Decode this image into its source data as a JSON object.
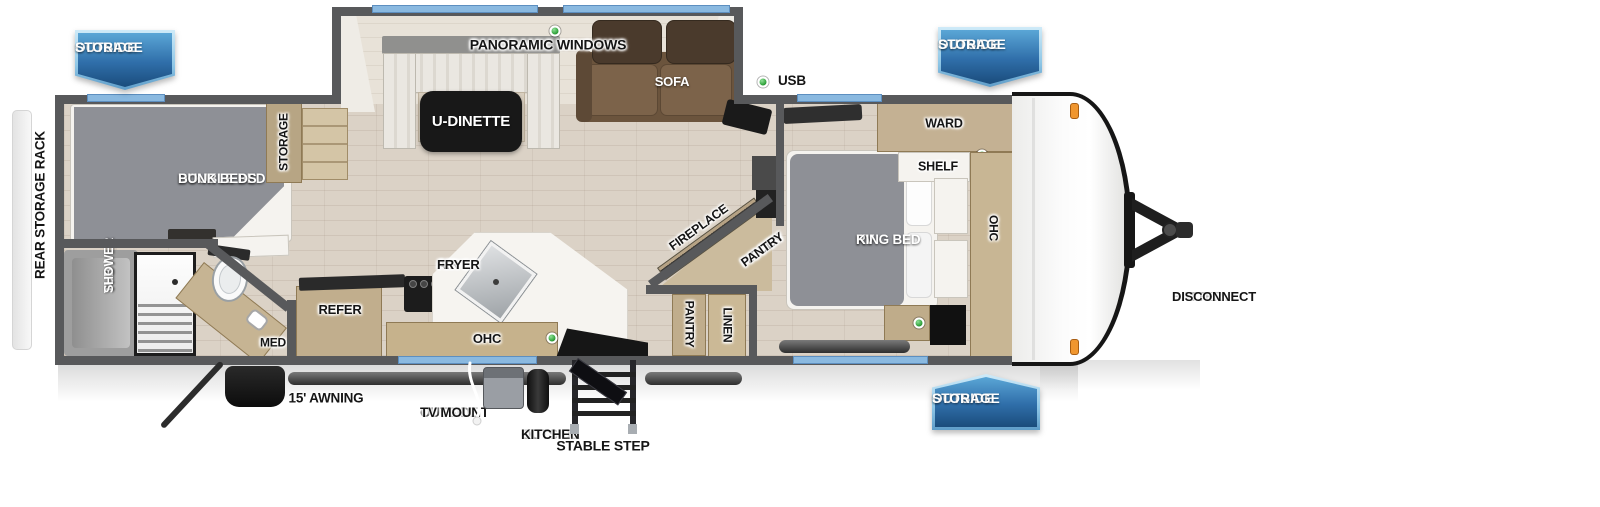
{
  "theme": {
    "wall": "#58595b",
    "floor": "#dbd2c6",
    "wood": "#c3b08e",
    "window-blue": "#8ab9e0",
    "led-green": "#2fa13a",
    "marker-orange": "#f0962f",
    "badge-blue": "#2f6ea9",
    "badge-blue-dark": "#1a4c7c",
    "badge-border": "#8ec6e6",
    "bed-gray": "#8e9096"
  },
  "exterior": {
    "badges": [
      {
        "line1": "OUTSIDE",
        "line2": "STORAGE"
      },
      {
        "line1": "OUTSIDE",
        "line2": "STORAGE"
      },
      {
        "line1": "OUTSIDE",
        "line2": "STORAGE"
      }
    ],
    "rear_rack": "REAR STORAGE RACK",
    "battery": {
      "line1": "BATTERY",
      "line2": "DISCONNECT"
    },
    "awning": "15' AWNING",
    "tv_mount": {
      "line1": "OUTSIDE",
      "line2": "TV MOUNT"
    },
    "outside_kitchen": {
      "line1": "OUTSIDE",
      "line2": "KITCHEN"
    },
    "stable_step": "STABLE STEP"
  },
  "living": {
    "panoramic_windows": "PANORAMIC WINDOWS",
    "u_dinette": "U-DINETTE",
    "sofa": "SOFA",
    "usb": "USB",
    "fireplace": "FIREPLACE",
    "hidden_pantry": {
      "line1": "HIDDEN",
      "line2": "PANTRY"
    }
  },
  "kitchen": {
    "air_fryer": {
      "line1": "AIR",
      "line2": "FRYER"
    },
    "refer": "REFER",
    "ohc": "OHC",
    "pantry": "PANTRY",
    "linen": "LINEN"
  },
  "bedroom": {
    "ward": "WARD",
    "shelf": "SHELF",
    "ohc": "OHC",
    "bed": {
      "line1": "RV",
      "line2": "KING BED"
    }
  },
  "bunk": {
    "bed": {
      "line1": "DOUBLE BED",
      "line2": "BUNK BEDS"
    },
    "storage": "STORAGE"
  },
  "bath": {
    "tub_shower": {
      "line1": "TUB /",
      "line2": "SHOWER"
    },
    "med": "MED"
  }
}
